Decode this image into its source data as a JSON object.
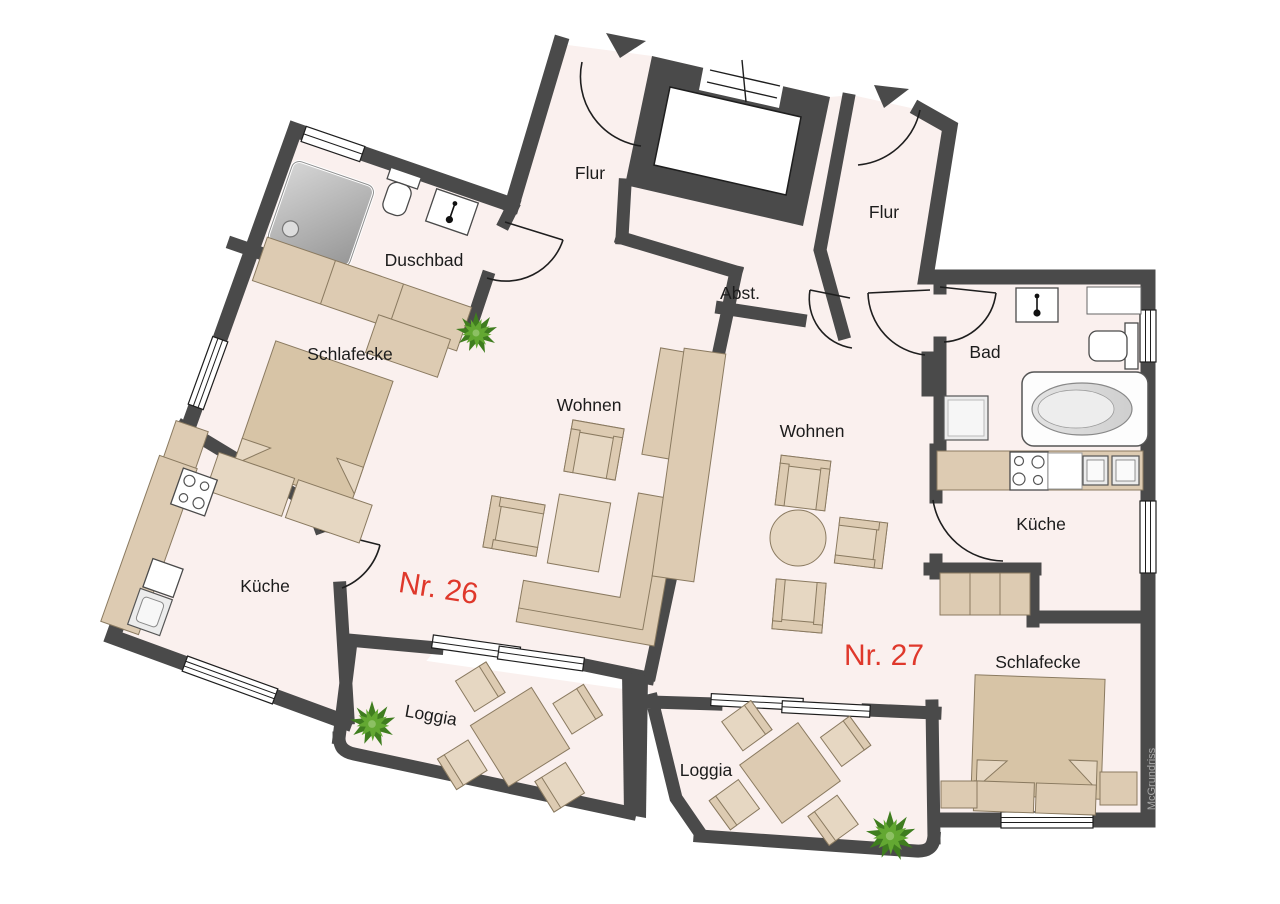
{
  "page": {
    "type": "floor-plan",
    "background": "#ffffff"
  },
  "colors": {
    "wall": "#4a4a4a",
    "floor": "#faf0ee",
    "furniture": "#ddcbb2",
    "furniture_dark": "#d7c4a6",
    "accent_red": "#df382b",
    "label_text": "#1c1c1c",
    "plant_green": "#4e8f2a",
    "watermark_gray": "#a8a8a8"
  },
  "apartments": [
    {
      "number": "Nr. 26",
      "rooms": [
        "Flur",
        "Duschbad",
        "Schlafecke",
        "Wohnen",
        "Küche",
        "Loggia"
      ]
    },
    {
      "number": "Nr. 27",
      "rooms": [
        "Flur",
        "Abst.",
        "Bad",
        "Wohnen",
        "Küche",
        "Schlafecke",
        "Loggia"
      ]
    }
  ],
  "labels": {
    "flur26": "Flur",
    "duschbad26": "Duschbad",
    "schlafecke26": "Schlafecke",
    "wohnen26": "Wohnen",
    "kueche26": "Küche",
    "nr26": "Nr. 26",
    "loggia26": "Loggia",
    "flur27": "Flur",
    "abst27": "Abst.",
    "bad27": "Bad",
    "wohnen27": "Wohnen",
    "kueche27": "Küche",
    "nr27": "Nr. 27",
    "schlafecke27": "Schlafecke",
    "loggia27": "Loggia",
    "watermark": "McGrundriss"
  },
  "icons": {
    "plant": "plant-icon",
    "entrance_arrow": "entrance-arrow-icon",
    "shower": "shower-icon",
    "toilet": "toilet-icon",
    "sink": "sink-icon",
    "bathtub": "bathtub-icon",
    "stove": "stove-icon",
    "washing_machine": "washing-machine-icon",
    "elevator": "elevator-shaft"
  }
}
